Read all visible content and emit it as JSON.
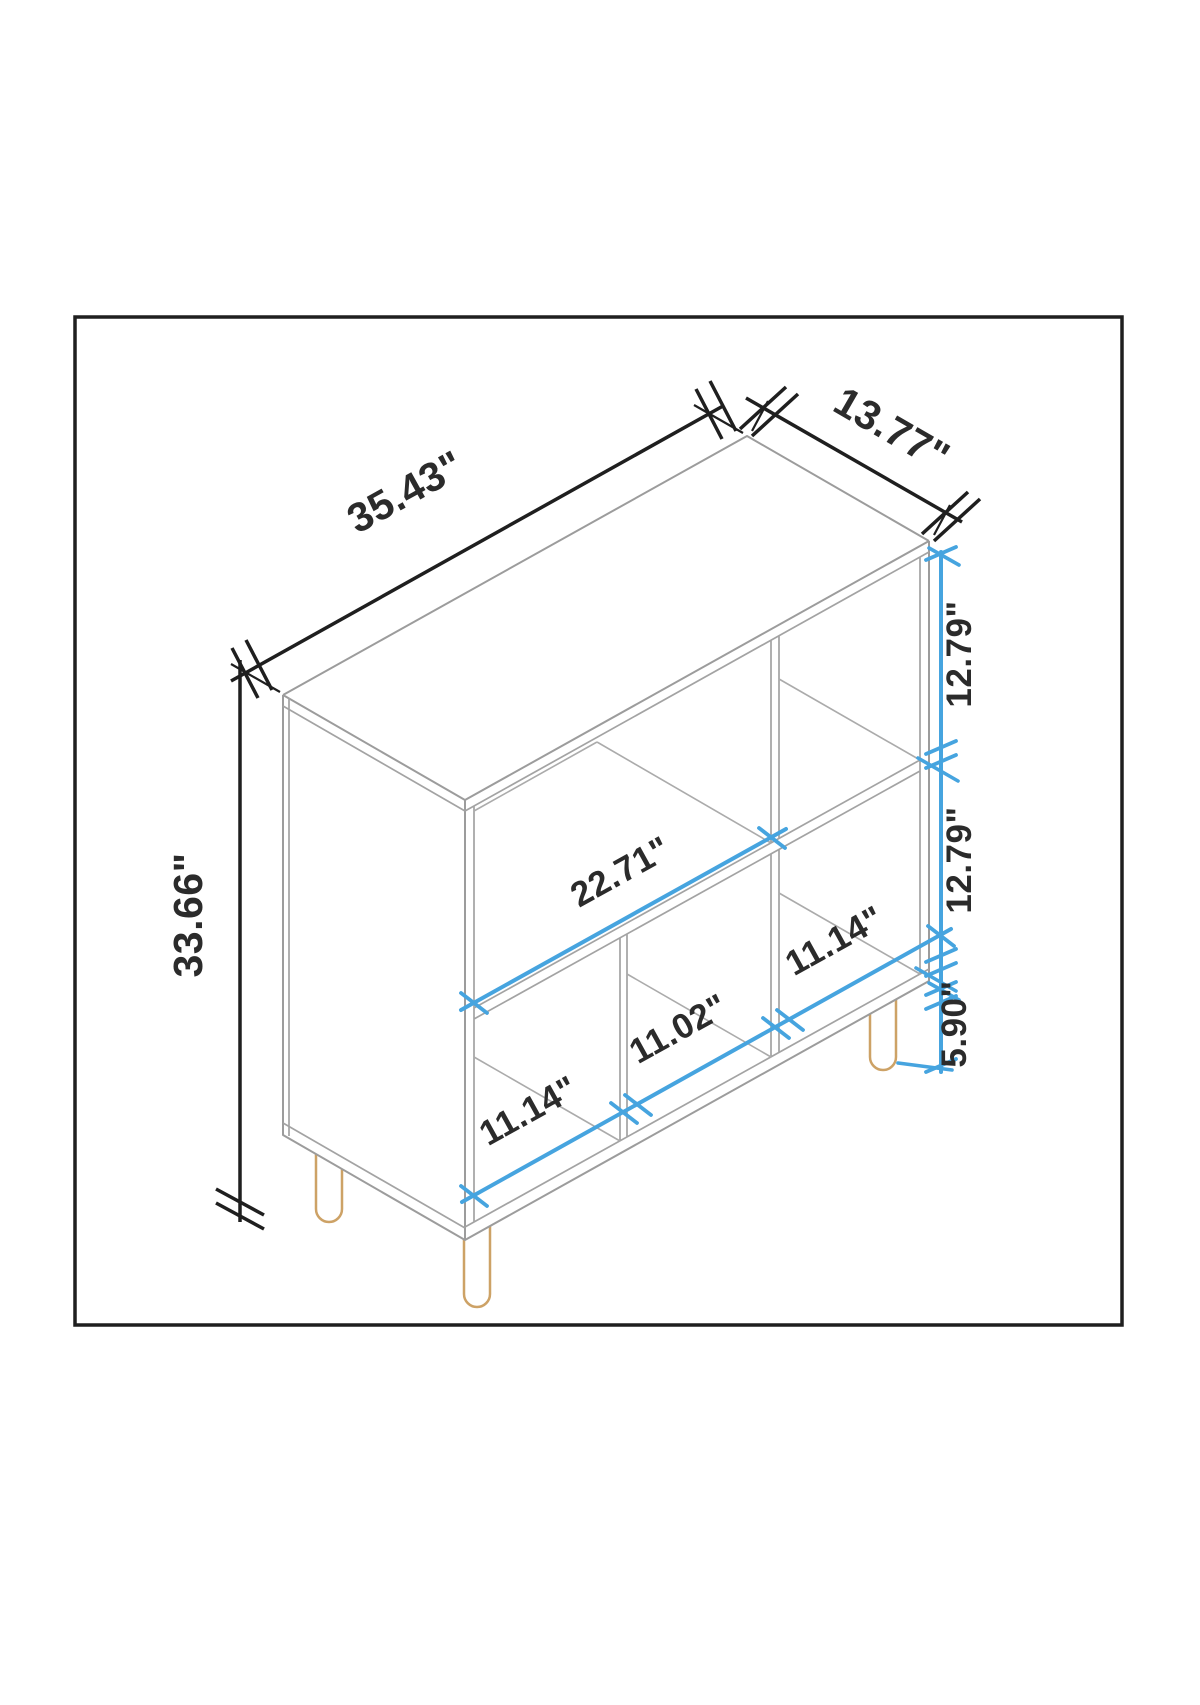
{
  "diagram": {
    "type": "isometric furniture dimension drawing",
    "dimensions": {
      "width": {
        "label": "35.43\"",
        "inches": 35.43
      },
      "depth": {
        "label": "13.77\"",
        "inches": 13.77
      },
      "height": {
        "label": "33.66\"",
        "inches": 33.66
      },
      "top_cubby_height": {
        "label": "12.79\"",
        "inches": 12.79
      },
      "bottom_cubby_height": {
        "label": "12.79\"",
        "inches": 12.79
      },
      "leg_height": {
        "label": "5.90\"",
        "inches": 5.9
      },
      "shelf_span": {
        "label": "22.71\"",
        "inches": 22.71
      },
      "cubby_left_width": {
        "label": "11.14\"",
        "inches": 11.14
      },
      "cubby_middle_width": {
        "label": "11.02\"",
        "inches": 11.02
      },
      "cubby_right_width": {
        "label": "11.14\"",
        "inches": 11.14
      }
    },
    "colors": {
      "dimension_accent": "#46a4df",
      "dimension_ink": "#1f1f1f",
      "outline_gray": "#9c9c9c",
      "leg_tan": "#cda266",
      "background": "#ffffff"
    }
  }
}
